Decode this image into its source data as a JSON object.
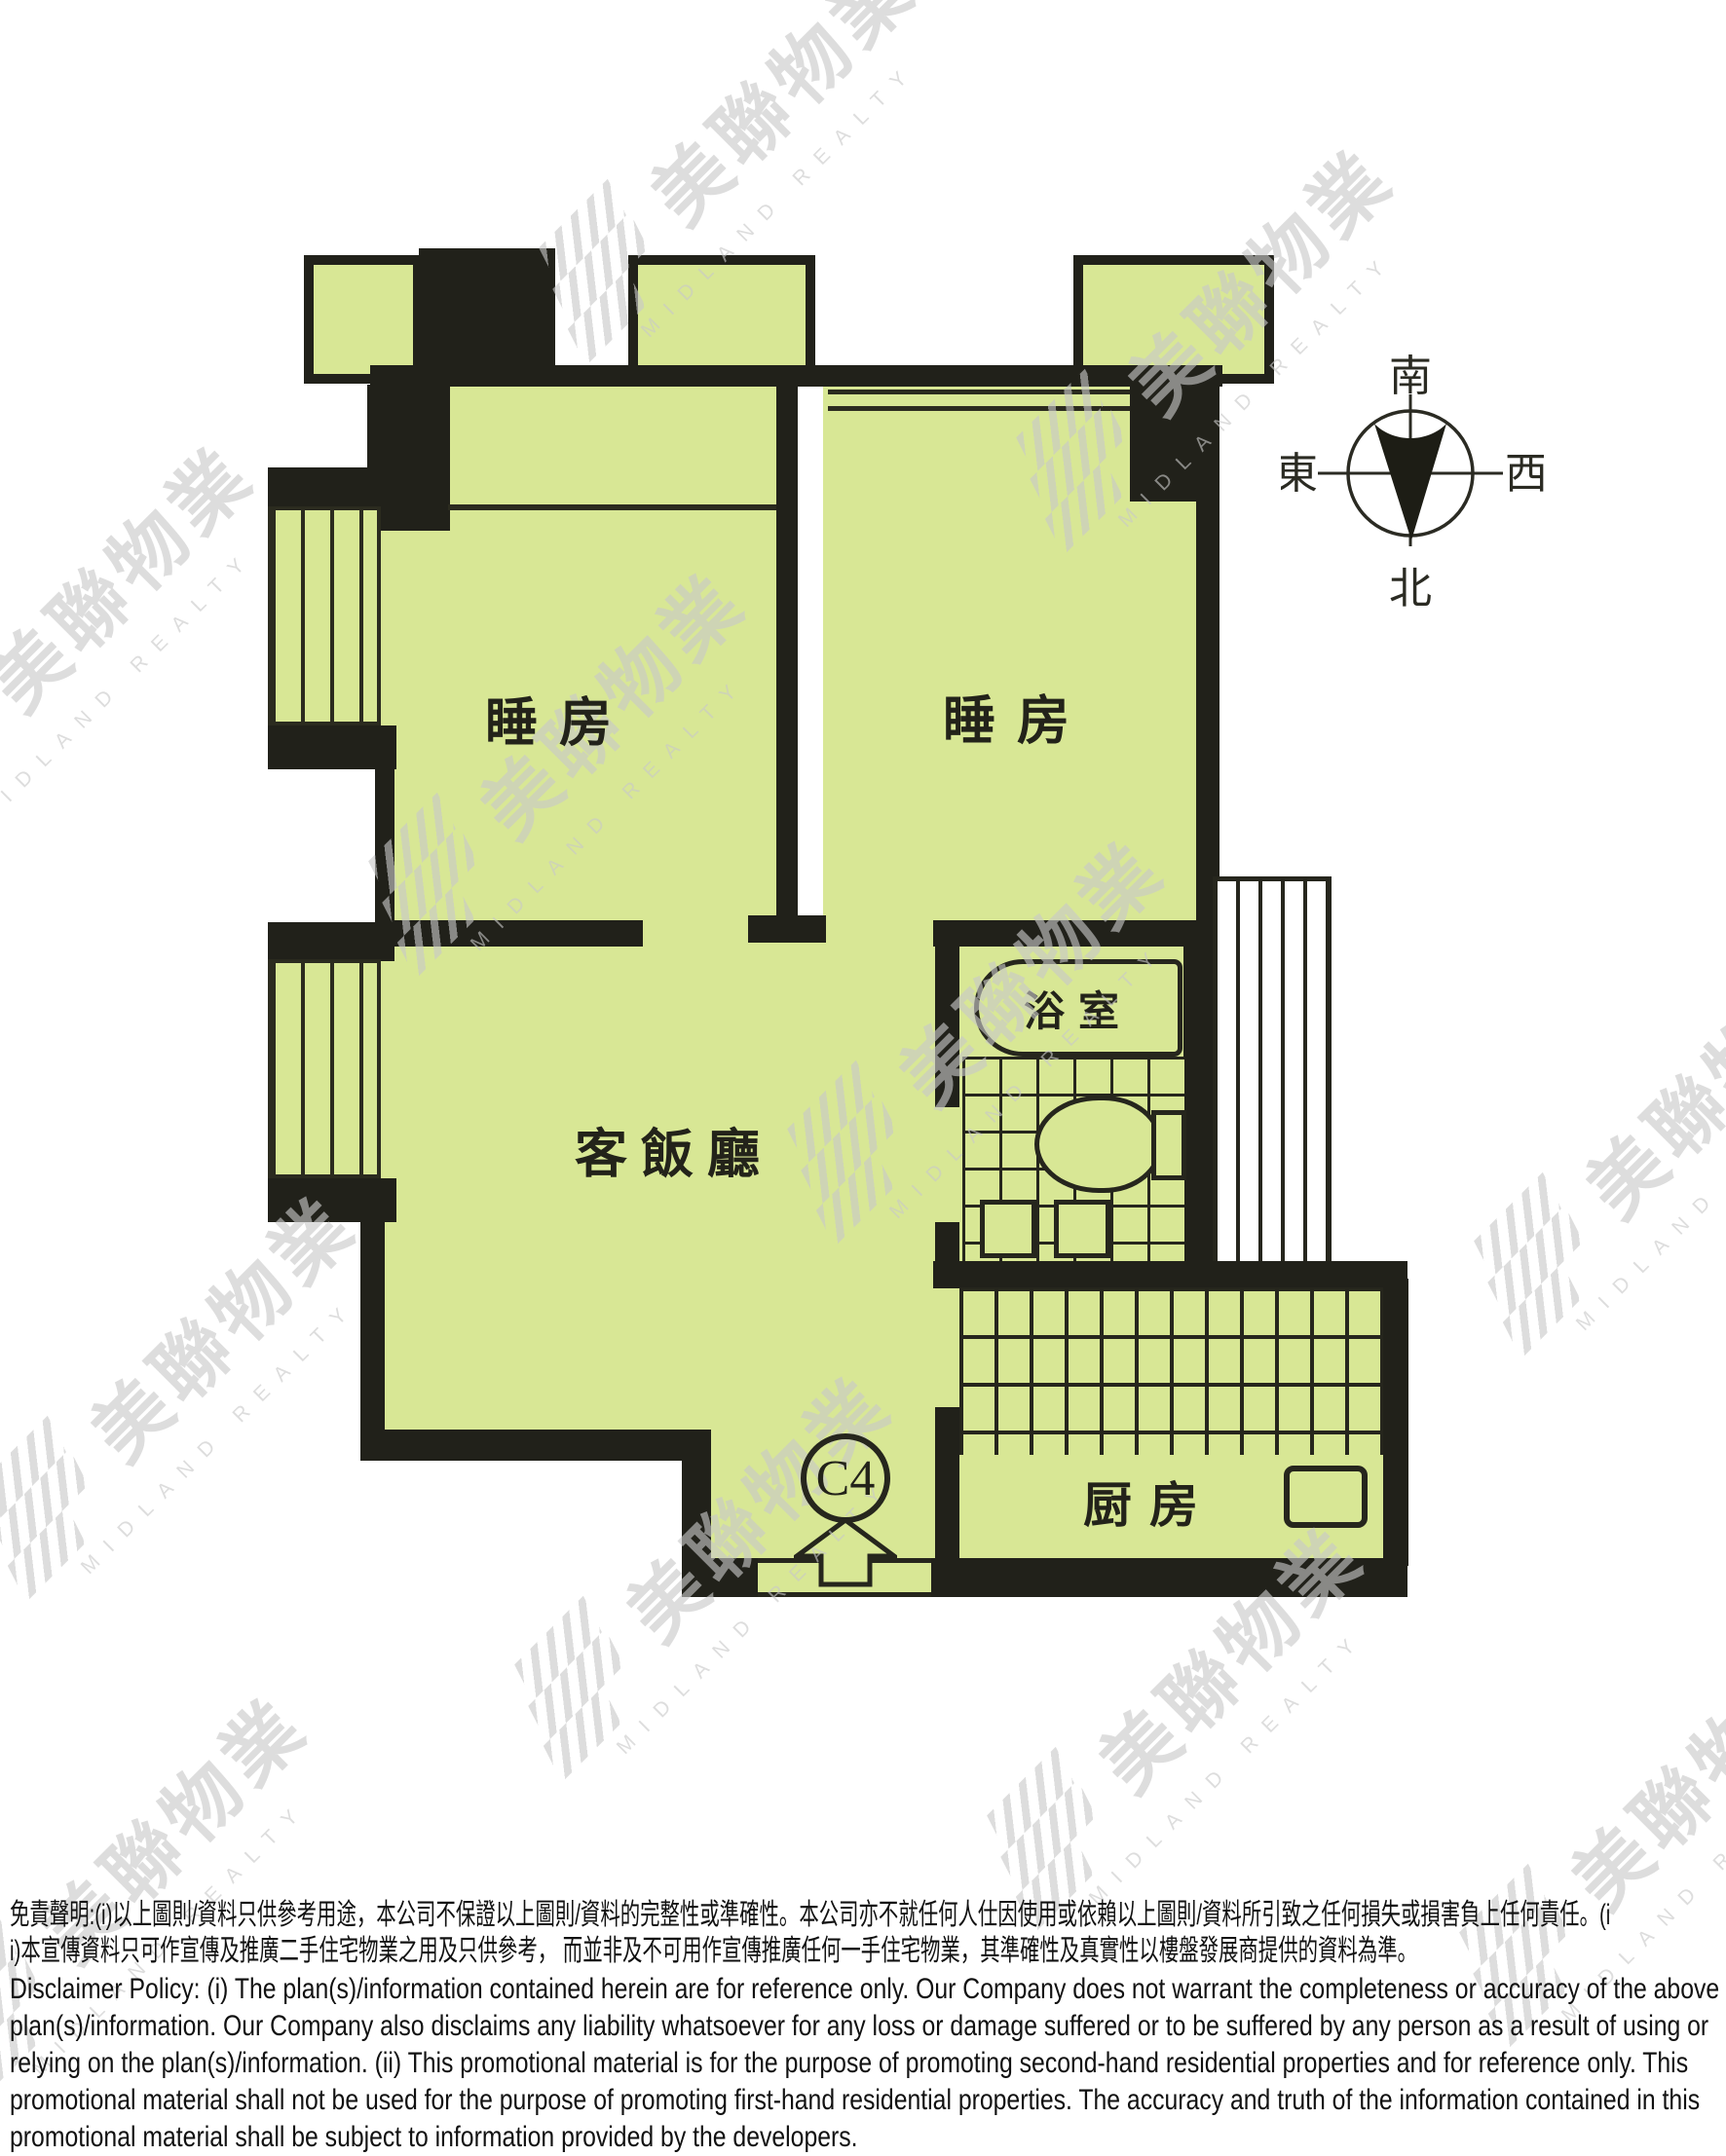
{
  "watermark": {
    "cjk": "美聯物業",
    "latin": "MIDLAND REALTY"
  },
  "compass": {
    "south": "南",
    "north": "北",
    "east": "東",
    "west": "西"
  },
  "rooms": {
    "bedroom1": "睡房",
    "bedroom2": "睡房",
    "living_dining": "客飯廳",
    "bathroom": "浴室",
    "kitchen": "厨房"
  },
  "unit": {
    "label": "C4"
  },
  "disclaimer": {
    "zh_line1": "免責聲明:(i)以上圖則/資料只供參考用途，本公司不保證以上圖則/資料的完整性或準確性。本公司亦不就任何人仕因使用或依賴以上圖則/資料所引致之任何損失或損害負上任何責任。(i",
    "zh_line2": "i)本宣傳資料只可作宣傳及推廣二手住宅物業之用及只供參考， 而並非及不可用作宣傳推廣任何一手住宅物業，其準確性及真實性以樓盤發展商提供的資料為準。",
    "en": "Disclaimer Policy: (i) The plan(s)/information contained herein are for reference only. Our Company does not warrant the completeness or accuracy of the above plan(s)/information. Our Company also disclaims any liability whatsoever for any loss or damage suffered or to be suffered by any person as a result of using or relying on the plan(s)/information. (ii) This promotional material is for the purpose of promoting second-hand residential properties and for reference only. This promotional material shall not be used for the purpose of promoting first-hand residential properties. The accuracy and truth of the information contained in this promotional material shall be subject to information provided by the developers."
  },
  "colors": {
    "room_green": "#d8e795",
    "wall_black": "#21211a",
    "watermark_gray": "#c9c9c9"
  }
}
